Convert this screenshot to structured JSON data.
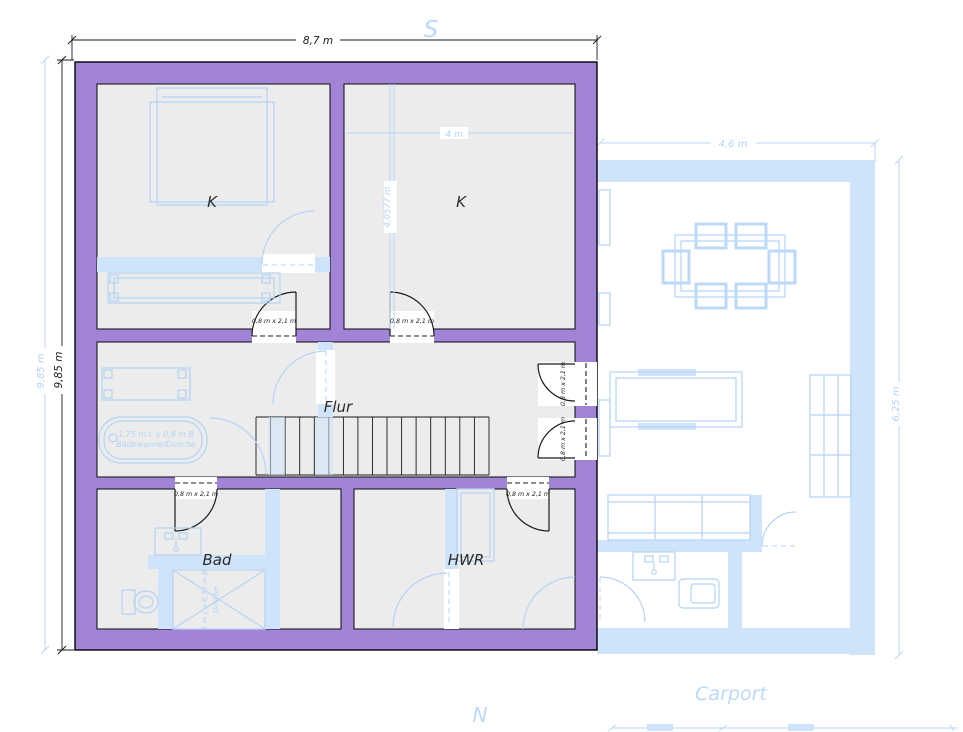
{
  "plan": {
    "compass": {
      "south": "S",
      "north": "N"
    },
    "ghost_area_label": {
      "carport": "Carport"
    },
    "rooms": {
      "k_left": {
        "label": "K"
      },
      "k_right": {
        "label": "K"
      },
      "flur": {
        "label": "Flur"
      },
      "bad": {
        "label": "Bad"
      },
      "hwr": {
        "label": "HWR"
      }
    },
    "door_size_label": "0,8 m x 2,1 m",
    "dimensions": {
      "building_width": "8,7 m",
      "building_height": "9,85 m",
      "ghost_building_height": "9,85 m",
      "ghost_width": "4,6 m",
      "ghost_height": "6,25 m",
      "room_width": "4 m",
      "room_height": "4,0577 m"
    },
    "fixtures": {
      "bathtub_line1": "1,75 m L x 0,8 m B",
      "bathtub_line2": "Badewanne/Dusche",
      "shower_line1": "1 m L x 0,75 m B",
      "shower_line2": "Dusche"
    },
    "colors": {
      "wall": "#a284d6",
      "floor": "#ececec",
      "ghost_fill": "#cfe3fa",
      "ghost_line": "#b5d3f4",
      "ghost_text": "#b3d3f6",
      "ink": "#1a1a1a"
    }
  }
}
